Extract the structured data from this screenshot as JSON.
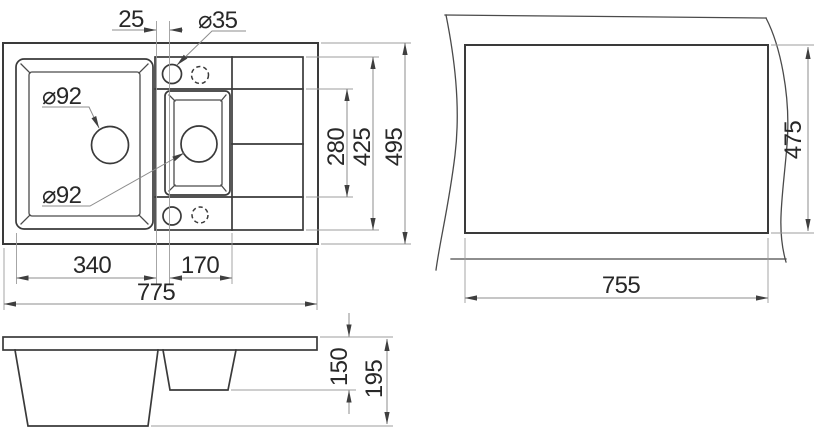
{
  "page": {
    "background": "#ffffff"
  },
  "drawing": {
    "line_color": "#3a3a3a",
    "dim_line_color": "#8c8c8c",
    "text_color": "#282828",
    "views": {
      "top": {
        "dims": {
          "faucet_offset": "25",
          "faucet_hole_dia": "⌀35",
          "main_drain_dia": "⌀92",
          "half_drain_dia": "⌀92",
          "mid_height": "280",
          "inner_height": "425",
          "overall_depth": "495",
          "main_bowl_width": "340",
          "half_bowl_width": "170",
          "overall_width": "775"
        }
      },
      "cutout": {
        "dims": {
          "height": "475",
          "width": "755"
        }
      },
      "side": {
        "dims": {
          "half_bowl_depth": "150",
          "overall_height": "195"
        }
      }
    }
  }
}
